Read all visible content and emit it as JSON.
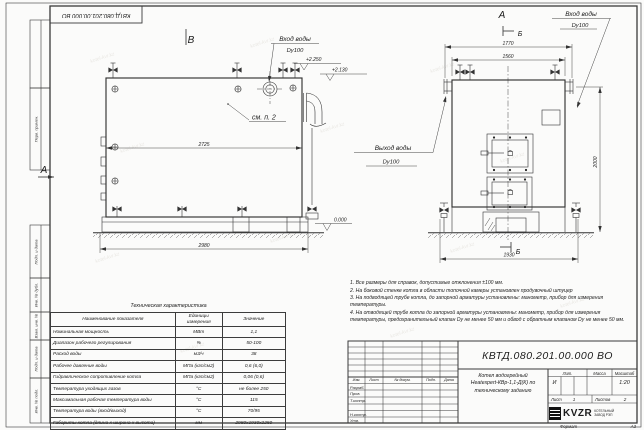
{
  "sheet": {
    "stamp": "КВТД.080.201.00.000 ВО",
    "side_labels": [
      "Перв. примен.",
      "Подп. и дата",
      "Инв. № дубл.",
      "Взам. инв. №",
      "Подп. и дата",
      "Инв. № подл."
    ],
    "format_label": "Формат",
    "format_value": "А3",
    "watermark": "kotel-kvr.kz"
  },
  "views": {
    "view_b": "В",
    "view_a": "А",
    "section_b": "Б",
    "see_note": "см. п. 2",
    "inlet_label": "Вход воды",
    "outlet_label": "Выход воды",
    "pipe_size": "Dy100",
    "left": {
      "dim_inner": "2725",
      "dim_outer": "2980",
      "elev_top": "+2.250",
      "elev_mid": "+2.130",
      "elev_zero": "0.000"
    },
    "right": {
      "dim_outer": "1770",
      "dim_inner": "1560",
      "dim_height": "2000",
      "dim_bottom": "1930"
    }
  },
  "notes": [
    "1. Все размеры для справок, допустимые отклонения ±100 мм.",
    "2. На боковой стенке котла в области топочной камеры установлен продувочный штуцер",
    "3. На подводящей трубе котла, до запорной арматуры установлены: манометр, прибор для измерения температуры.",
    "4. На отводящей трубе котла до запорной арматуры установлены: манометр, прибор для измерения температуры, предохранительный клапан Dу не менее 50 мм и обвод с обратным клапаном Dу не менее 50 мм."
  ],
  "tech_table": {
    "title": "Техническая характеристика",
    "headers": [
      "Наименование показателя",
      "Единицы измерения",
      "Значение"
    ],
    "rows": [
      [
        "Номинальная мощность",
        "МВт",
        "1,1"
      ],
      [
        "Диапазон рабочего регулирования",
        "%",
        "50-100"
      ],
      [
        "Расход воды",
        "м3/ч",
        "38"
      ],
      [
        "Рабочее давление воды",
        "МПа (кгс/см2)",
        "0,6 (6,0)"
      ],
      [
        "Гидравлическое сопротивление котла",
        "МПа (кгс/см2)",
        "0,06 (0,6)"
      ],
      [
        "Температура уходящих газов",
        "°С",
        "не более 250"
      ],
      [
        "Максимальная рабочая температура воды",
        "°С",
        "115"
      ],
      [
        "Температура воды (вход/выход)",
        "°С",
        "70/95"
      ],
      [
        "Габариты котла (длина х ширина х высота)",
        "мм",
        "2980х1930х2250"
      ]
    ]
  },
  "title_block": {
    "doc_number": "КВТД.080.201.00.000  ВО",
    "title_lines": [
      "Котел водогрейный",
      "Heatexpert-КВр-1,1-Д(К) по",
      "техническому заданию"
    ],
    "header_cols": [
      "Изм.",
      "Лист",
      "№ докум.",
      "Подп.",
      "Дата"
    ],
    "row_labels": [
      "Разраб.",
      "Пров.",
      "Т.контр.",
      "Н.контр.",
      "Утв."
    ],
    "lit_label": "Лит.",
    "lit_value": "И",
    "mass_label": "Масса",
    "scale_label": "Масштаб",
    "scale_value": "1:20",
    "sheet_label": "Лист",
    "sheet_value": "1",
    "sheets_label": "Листов",
    "sheets_value": "2",
    "logo_text": "KVZR",
    "logo_sub": [
      "КОТЕЛЬНЫЙ",
      "ЗАВОД РЭП"
    ]
  }
}
